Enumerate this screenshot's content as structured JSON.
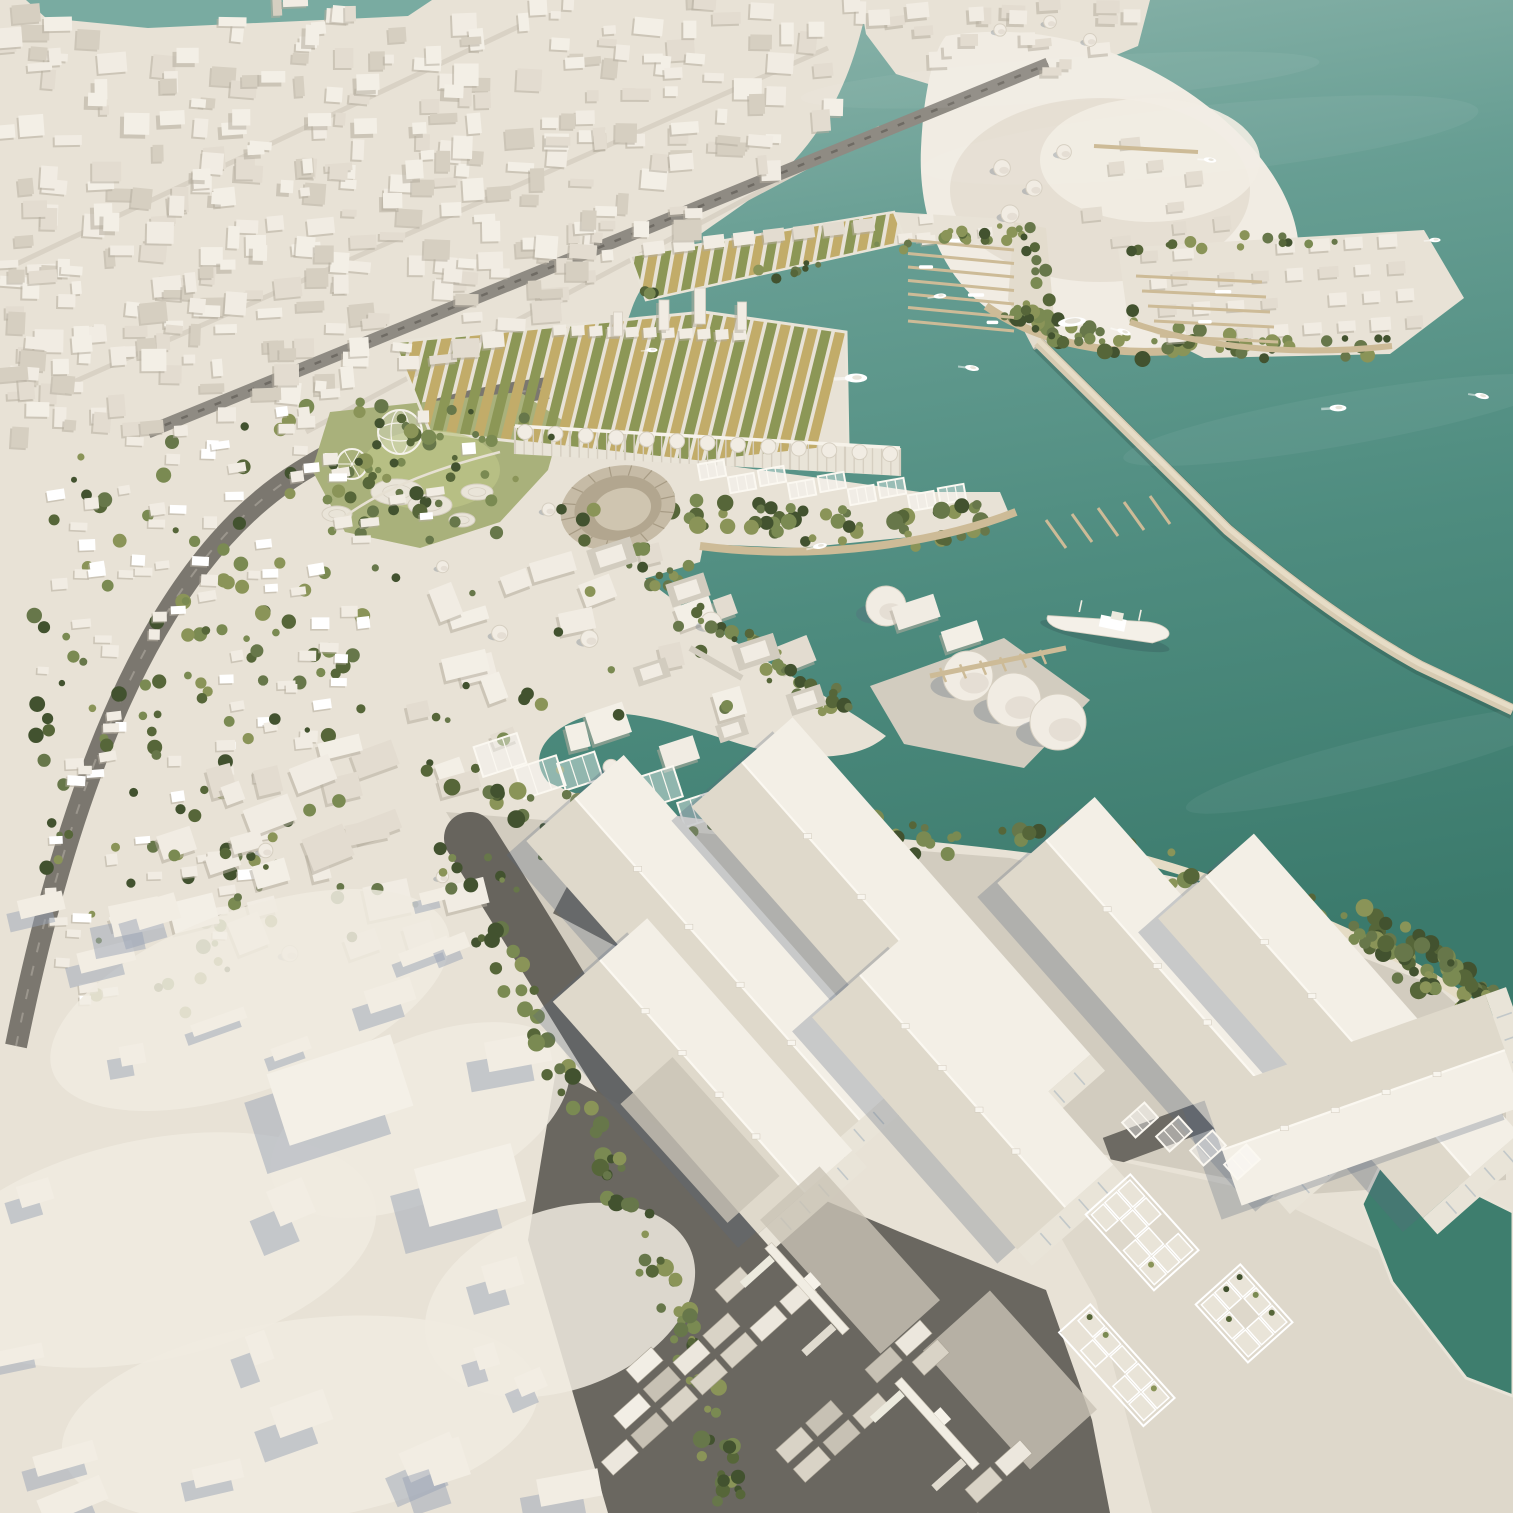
{
  "scene": {
    "title": "Aerial 3D architectural masterplan render of a coastal harbor city",
    "style": "white massing model, teal sea, green tree clusters, warm daylight from upper right",
    "view": "high oblique aerial",
    "regions": [
      {
        "name": "dense-city-grid",
        "label": "Existing city massing"
      },
      {
        "name": "shore-towers",
        "label": "Waterfront towers"
      },
      {
        "name": "sand-headland",
        "label": "Sandy headland"
      },
      {
        "name": "seaside-village",
        "label": "Seaside village blocks"
      },
      {
        "name": "marina",
        "label": "Marina piers with yachts"
      },
      {
        "name": "harbor-basin",
        "label": "Inner harbor basin"
      },
      {
        "name": "farm-quay",
        "label": "Floating farm quay with striped plots"
      },
      {
        "name": "central-park",
        "label": "Park with dome and ferris wheel"
      },
      {
        "name": "amphitheater",
        "label": "Circular amphitheater"
      },
      {
        "name": "silo-arcade",
        "label": "Silo colonnade building"
      },
      {
        "name": "residential-district",
        "label": "Low-rise green residential grid"
      },
      {
        "name": "canal-campus",
        "label": "Industrial campus with silos and canals"
      },
      {
        "name": "tank-terminal",
        "label": "Cylindrical storage tanks"
      },
      {
        "name": "cargo-ship",
        "label": "Docked white ship"
      },
      {
        "name": "breakwater",
        "label": "Long stone breakwater"
      },
      {
        "name": "warehouse-district",
        "label": "Gabled warehouse sheds"
      },
      {
        "name": "container-terminal",
        "label": "Container stacks and gantry cranes"
      },
      {
        "name": "modular-yard",
        "label": "Modular frame buildings"
      },
      {
        "name": "dock-basin",
        "label": "Green dock basin"
      },
      {
        "name": "hillside-terrain",
        "label": "Smooth white hillside massing"
      },
      {
        "name": "open-sea",
        "label": "Open teal sea"
      }
    ]
  },
  "palette": {
    "land": "#e8e2d6",
    "sea_haze": "#8fb6ad",
    "sea_light": "#679e93",
    "sea_mid": "#4e8c7f",
    "sea_deep": "#3b7a6c",
    "sliver": "#79aba1",
    "basin": "#3e7e6e",
    "massing": "#f1ece3",
    "massing_mid": "#e3dcd0",
    "massing_dark": "#d6cfc1",
    "block_shadow": "#b4ad9f",
    "cool_shadow": "#9aa4b6",
    "road": "#7b776f",
    "asphalt": "#67645d",
    "rail": "#8f8b83",
    "street": "#d9d2c5",
    "concrete": "#d2ccbf",
    "concrete_light": "#ded8cb",
    "deck": "#cdbb97",
    "breakwater": "#d7cbb2",
    "sand": "#e5dcc5",
    "spit_sand": "#e3dccd",
    "farm_tan": "#c2ac69",
    "farm_green": "#8c9756",
    "park": "#a9b17b",
    "park_light": "#bec489",
    "roof_light": "#f3efe6",
    "roof_shade": "#dfd9cb",
    "gable": "#e9e4d8",
    "glazing": "#c2c8c9",
    "stone": "#c6bba6",
    "stone_dark": "#b2a68f",
    "stone_floor": "#cfc5b0",
    "white": "#fbf8f1",
    "trees": [
      "#42522f",
      "#566639",
      "#67774a",
      "#7a8a52",
      "#8a9458"
    ]
  }
}
